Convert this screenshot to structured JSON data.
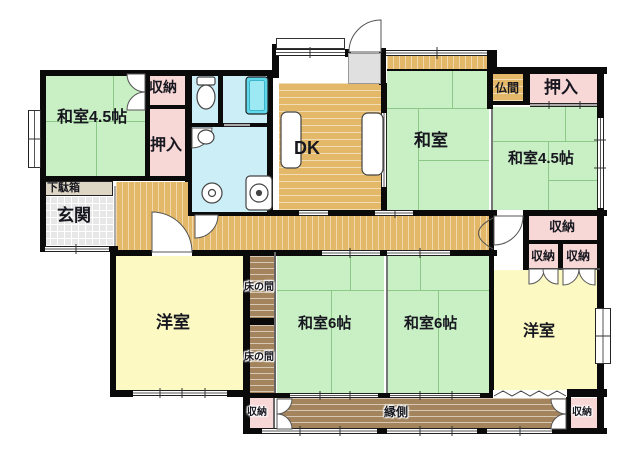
{
  "floorplan": {
    "type": "japanese-house-floor-plan",
    "labels": {
      "washitsu45_tl": "和室4.5帖",
      "shuno_tl": "収納",
      "oshiire_l": "押入",
      "getabako": "下駄箱",
      "genkan": "玄関",
      "dk": "DK",
      "washitsu_c": "和室",
      "butsuma": "仏間",
      "oshiire_tr": "押入",
      "washitsu45_tr": "和室4.5帖",
      "shuno_r": "収納",
      "shuno_r1": "収納",
      "shuno_r2": "収納",
      "yoshitsu_l": "洋室",
      "tokonoma_upper": "床の間",
      "tokonoma_lower": "床の間",
      "washitsu6_l": "和室6帖",
      "washitsu6_r": "和室6帖",
      "yoshitsu_r": "洋室",
      "engawa": "縁側",
      "shuno_bl": "収納",
      "shuno_br": "収納"
    },
    "colors": {
      "tatami_green": "#c9efc4",
      "closet_pink": "#f8d7d7",
      "western_yellow": "#fcf9c3",
      "water_cyan": "#cceef7",
      "wood_tan": "#e3b969",
      "veranda_brown": "#a3845c",
      "bathtub_cyan": "#5fd8ec",
      "wall_black": "#0a0a0a",
      "entrance_gray": "#e7e7e7"
    }
  }
}
